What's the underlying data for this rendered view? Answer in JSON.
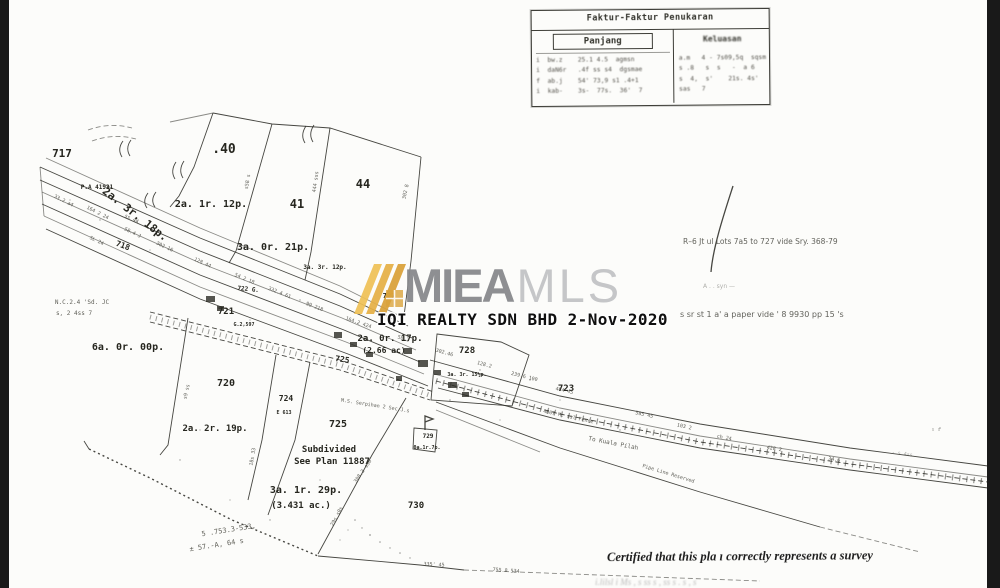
{
  "watermark": {
    "brand_bold": "MIEA",
    "brand_light": "MLS",
    "subtitle": "IQI REALTY SDN BHD 2-Nov-2020",
    "logo_gold_light": "#EFC055",
    "logo_gold_mid": "#E5AF43",
    "logo_gold_dark": "#D99F35",
    "brand_gray": "#898a8d",
    "brand_light_gray": "#c5c6c8"
  },
  "table": {
    "title": "Faktur-Faktur Penukaran",
    "col_left": "Panjang",
    "col_right": "Keluasan",
    "rows": [
      {
        "left": "i  bw.z    25.1 4.5  agmsn",
        "right": "a.m   4 - 7s09,5q  sqsm"
      },
      {
        "left": "i  daN6r   .4f ss s4  dgsmae",
        "right": "s .8   s  s   -  a 6"
      },
      {
        "left": "f  ab.j    54' 73,9 s1 .4+1",
        "right": "s  4,  s'    21s. 4s'"
      },
      {
        "left": "i  kab-    3s-  77s.  36'  7",
        "right": "sas   7"
      }
    ]
  },
  "map": {
    "certification": "Certified that this pla ı correctly represents a survey",
    "bottom_cutoff": "i.lilsl  i  Ms  ,  s   ss s  ,  ss  s   .   s ,   s",
    "labels": [
      {
        "t": "717",
        "x": 62,
        "y": 157,
        "s": 11
      },
      {
        "t": "P.A 41931",
        "x": 97,
        "y": 189,
        "s": 6
      },
      {
        "t": "2a. 3r. 18p.",
        "x": 133,
        "y": 217,
        "s": 11,
        "r": 38
      },
      {
        "t": "718",
        "x": 122,
        "y": 248,
        "s": 8,
        "r": 20
      },
      {
        "t": ".40",
        "x": 224,
        "y": 153,
        "s": 13
      },
      {
        "t": "41",
        "x": 297,
        "y": 208,
        "s": 12
      },
      {
        "t": "44",
        "x": 363,
        "y": 188,
        "s": 12
      },
      {
        "t": "2a. 1r. 12p.",
        "x": 211,
        "y": 207,
        "s": 10
      },
      {
        "t": "3a. 0r. 21p.",
        "x": 273,
        "y": 250,
        "s": 10
      },
      {
        "t": "3a. 3r. 12p.",
        "x": 325,
        "y": 269,
        "s": 6
      },
      {
        "t": "722 G.",
        "x": 248,
        "y": 291,
        "s": 6,
        "r": 6
      },
      {
        "t": "721",
        "x": 226,
        "y": 314,
        "s": 9
      },
      {
        "t": "G.2,597",
        "x": 244,
        "y": 326,
        "s": 5
      },
      {
        "t": "727",
        "x": 389,
        "y": 298,
        "s": 7
      },
      {
        "t": "2a. 0r. 17p.",
        "x": 390,
        "y": 341,
        "s": 9
      },
      {
        "t": "(2.66 ac)",
        "x": 384,
        "y": 353,
        "s": 8
      },
      {
        "t": "725",
        "x": 342,
        "y": 362,
        "s": 8,
        "r": 8
      },
      {
        "t": "728",
        "x": 467,
        "y": 353,
        "s": 9
      },
      {
        "t": "3a. 3r. 15½p.",
        "x": 467,
        "y": 376,
        "s": 5
      },
      {
        "t": "723",
        "x": 566,
        "y": 391,
        "s": 9
      },
      {
        "t": "720",
        "x": 226,
        "y": 386,
        "s": 10
      },
      {
        "t": "724",
        "x": 286,
        "y": 401,
        "s": 8
      },
      {
        "t": "E 613",
        "x": 284,
        "y": 414,
        "s": 5
      },
      {
        "t": "2a. 2r. 19p.",
        "x": 215,
        "y": 431,
        "s": 9
      },
      {
        "t": "725",
        "x": 338,
        "y": 427,
        "s": 10
      },
      {
        "t": "Subdivided",
        "x": 329,
        "y": 452,
        "s": 9
      },
      {
        "t": "See Plan 11887",
        "x": 332,
        "y": 464,
        "s": 9
      },
      {
        "t": "3a. 1r. 29p.",
        "x": 306,
        "y": 493,
        "s": 10
      },
      {
        "t": "(3.431 ac.)",
        "x": 301,
        "y": 508,
        "s": 9
      },
      {
        "t": "729",
        "x": 428,
        "y": 438,
        "s": 6
      },
      {
        "t": "0a.1r.7p.",
        "x": 427,
        "y": 449,
        "s": 5
      },
      {
        "t": "730",
        "x": 416,
        "y": 508,
        "s": 9
      },
      {
        "t": "6a. 0r. 00p.",
        "x": 128,
        "y": 350,
        "s": 10
      },
      {
        "t": "To Kuala Pilah",
        "x": 613,
        "y": 445,
        "s": 6,
        "r": 11,
        "c": "n"
      },
      {
        "t": "Pipe Line Reserved",
        "x": 668,
        "y": 475,
        "s": 5,
        "r": 17,
        "c": "n"
      },
      {
        "t": "M.S. Serpihan 2 Sec J.s",
        "x": 375,
        "y": 407,
        "s": 5,
        "r": 9,
        "c": "n"
      },
      {
        "t": "4607 M. ssl Fence",
        "x": 568,
        "y": 418,
        "s": 5,
        "r": 12,
        "c": "n"
      },
      {
        "t": "R–6 Jt ul Lots 7a5 to 727 vide Sry. 368-79",
        "x": 683,
        "y": 244,
        "s": 7.5,
        "a": "s",
        "c": "ann"
      },
      {
        "t": "A   .  . syn   —",
        "x": 703,
        "y": 288,
        "s": 6,
        "a": "s",
        "c": "ann ft"
      },
      {
        "t": "s sr  st 1 a'  a paper vide ' 8 9930 pp 15 's",
        "x": 680,
        "y": 317,
        "s": 8,
        "a": "s",
        "c": "ann"
      },
      {
        "t": "N.C.2.4 'Sd. JC",
        "x": 82,
        "y": 304,
        "s": 6,
        "c": "n"
      },
      {
        "t": "s, 2 4ss 7",
        "x": 74,
        "y": 315,
        "s": 6,
        "c": "n"
      },
      {
        "t": "5 .753.3-533,",
        "x": 229,
        "y": 532,
        "s": 7,
        "r": -9,
        "c": "n"
      },
      {
        "t": "± 57.-A, 64 s",
        "x": 217,
        "y": 547,
        "s": 7,
        "r": -9,
        "c": "n"
      },
      {
        "t": "33.2 a4",
        "x": 63,
        "y": 202,
        "r": 27,
        "s": 5,
        "c": "n"
      },
      {
        "t": "164 2 24",
        "x": 97,
        "y": 214,
        "r": 27,
        "s": 5,
        "c": "n"
      },
      {
        "t": "58.4 J",
        "x": 132,
        "y": 234,
        "r": 26,
        "s": 5,
        "c": "n"
      },
      {
        "t": "302 16",
        "x": 164,
        "y": 248,
        "r": 25,
        "s": 5,
        "c": "n"
      },
      {
        "t": "128 44",
        "x": 202,
        "y": 264,
        "r": 24,
        "s": 5,
        "c": "n"
      },
      {
        "t": "54 2 18",
        "x": 244,
        "y": 280,
        "r": 23,
        "s": 5,
        "c": "n"
      },
      {
        "t": "332.4 61",
        "x": 279,
        "y": 294,
        "r": 22,
        "s": 5,
        "c": "n"
      },
      {
        "t": "99 218",
        "x": 314,
        "y": 308,
        "r": 21,
        "s": 5,
        "c": "n"
      },
      {
        "t": "164.2 424",
        "x": 358,
        "y": 324,
        "r": 19,
        "s": 5,
        "c": "n"
      },
      {
        "t": "58 2",
        "x": 403,
        "y": 340,
        "r": 17,
        "s": 5,
        "c": "n"
      },
      {
        "t": "302.46",
        "x": 444,
        "y": 354,
        "r": 16,
        "s": 5,
        "c": "n"
      },
      {
        "t": "128.2",
        "x": 484,
        "y": 366,
        "r": 15,
        "s": 5,
        "c": "n"
      },
      {
        "t": "239.6 100",
        "x": 524,
        "y": 378,
        "r": 14,
        "s": 5,
        "c": "n"
      },
      {
        "t": "464 45",
        "x": 564,
        "y": 392,
        "r": 13,
        "s": 5,
        "c": "n"
      },
      {
        "t": "585 45",
        "x": 644,
        "y": 416,
        "r": 12,
        "s": 5,
        "c": "n"
      },
      {
        "t": "103 2",
        "x": 684,
        "y": 428,
        "r": 12,
        "s": 5,
        "c": "n"
      },
      {
        "t": "ch 24",
        "x": 724,
        "y": 439,
        "r": 11,
        "s": 5,
        "c": "n"
      },
      {
        "t": "428 2",
        "x": 774,
        "y": 450,
        "r": 10,
        "s": 5,
        "c": "n"
      },
      {
        "t": "34.6",
        "x": 834,
        "y": 461,
        "r": 9,
        "s": 5,
        "c": "n"
      },
      {
        "t": "- s 4ss",
        "x": 902,
        "y": 455,
        "r": 9,
        "s": 5,
        "c": "n ft"
      },
      {
        "t": "335' 45",
        "x": 434,
        "y": 566,
        "r": 3,
        "s": 5,
        "c": "n"
      },
      {
        "t": "755.8 534",
        "x": 506,
        "y": 572,
        "r": 4,
        "s": 5,
        "c": "n"
      },
      {
        "t": "302 8",
        "x": 407,
        "y": 192,
        "r": -78,
        "s": 5,
        "c": "n"
      },
      {
        "t": "444 sss",
        "x": 317,
        "y": 182,
        "r": -82,
        "s": 5,
        "c": "n"
      },
      {
        "t": "s58 s",
        "x": 249,
        "y": 182,
        "r": -80,
        "s": 5,
        "c": "n"
      },
      {
        "t": "308.3 s50",
        "x": 364,
        "y": 472,
        "r": -55,
        "s": 5,
        "c": "n"
      },
      {
        "t": "29s s0s",
        "x": 338,
        "y": 517,
        "r": -62,
        "s": 5,
        "c": "n"
      },
      {
        "t": "18s 33",
        "x": 254,
        "y": 457,
        "r": -80,
        "s": 5,
        "c": "n"
      },
      {
        "t": "s9 ss",
        "x": 188,
        "y": 392,
        "r": -78,
        "s": 5,
        "c": "n"
      },
      {
        "t": "SL 24",
        "x": 96,
        "y": 242,
        "r": 26,
        "s": 5,
        "c": "n"
      },
      {
        "t": "ss 44",
        "x": 131,
        "y": 220,
        "r": 26,
        "s": 5,
        "c": "n"
      },
      {
        "t": "s s",
        "x": 936,
        "y": 431,
        "s": 5,
        "c": "n ft"
      }
    ]
  }
}
